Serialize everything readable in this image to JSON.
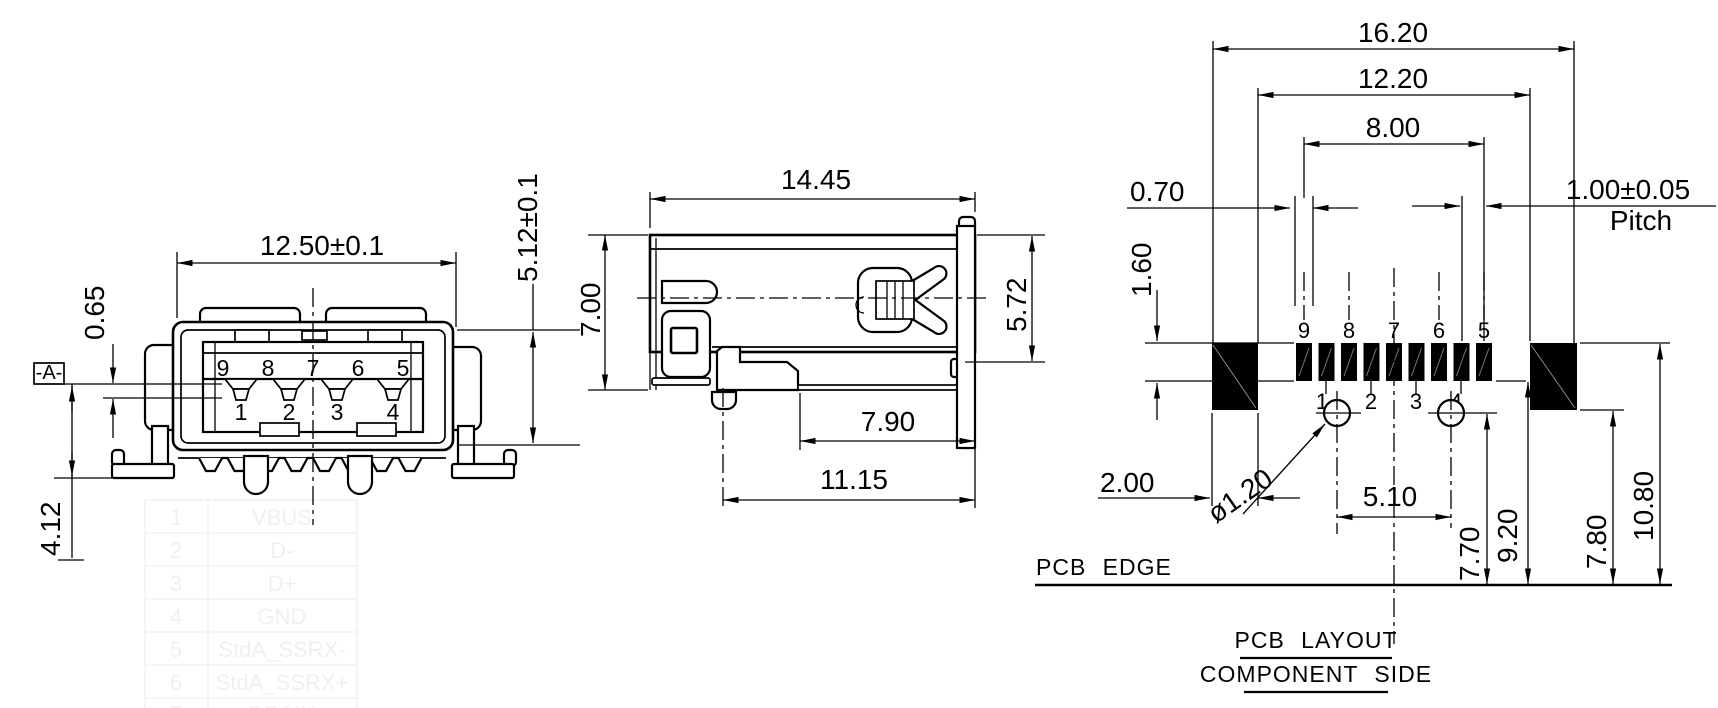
{
  "front_view": {
    "datum_label": "-A-",
    "dim_width": "12.50±0.1",
    "dim_contact_offset": "0.65",
    "dim_seating_height": "4.12",
    "dim_shell_height": "5.12±0.1",
    "top_row_pins": [
      "9",
      "8",
      "7",
      "6",
      "5"
    ],
    "bottom_row_pins": [
      "1",
      "2",
      "3",
      "4"
    ]
  },
  "side_view": {
    "dim_length": "14.45",
    "dim_height": "7.00",
    "dim_shell_depth": "5.72",
    "dim_lead_setback": "7.90",
    "dim_total_depth": "11.15"
  },
  "pcb_view": {
    "dim_total_width": "16.20",
    "dim_inner_span": "12.20",
    "dim_signal_span": "8.00",
    "dim_pad_width": "0.70",
    "dim_pitch": "1.00±0.05",
    "pitch_label": "Pitch",
    "dim_pad_length": "1.60",
    "dim_mount_pad_width": "2.00",
    "dim_hole_dia": "ø1.20",
    "dim_hole_spacing": "5.10",
    "dim_hole_to_edge": "7.70",
    "dim_pads_to_edge": "9.20",
    "dim_mount_to_edge": "7.80",
    "dim_front_to_edge": "10.80",
    "top_pad_labels": [
      "9",
      "8",
      "7",
      "6",
      "5"
    ],
    "bottom_pad_labels": [
      "1",
      "2",
      "3",
      "4"
    ],
    "pcb_edge_label": "PCB EDGE",
    "title": "PCB LAYOUT",
    "subtitle": "COMPONENT SIDE"
  },
  "watermark_table": {
    "rows": [
      [
        "1",
        "VBUS"
      ],
      [
        "2",
        "D-"
      ],
      [
        "3",
        "D+"
      ],
      [
        "4",
        "GND"
      ],
      [
        "5",
        "StdA_SSRX-"
      ],
      [
        "6",
        "StdA_SSRX+"
      ],
      [
        "7",
        "DRAIN"
      ]
    ]
  },
  "colors": {
    "line": "#000000",
    "background": "#ffffff",
    "pad_fill": "#000000"
  }
}
